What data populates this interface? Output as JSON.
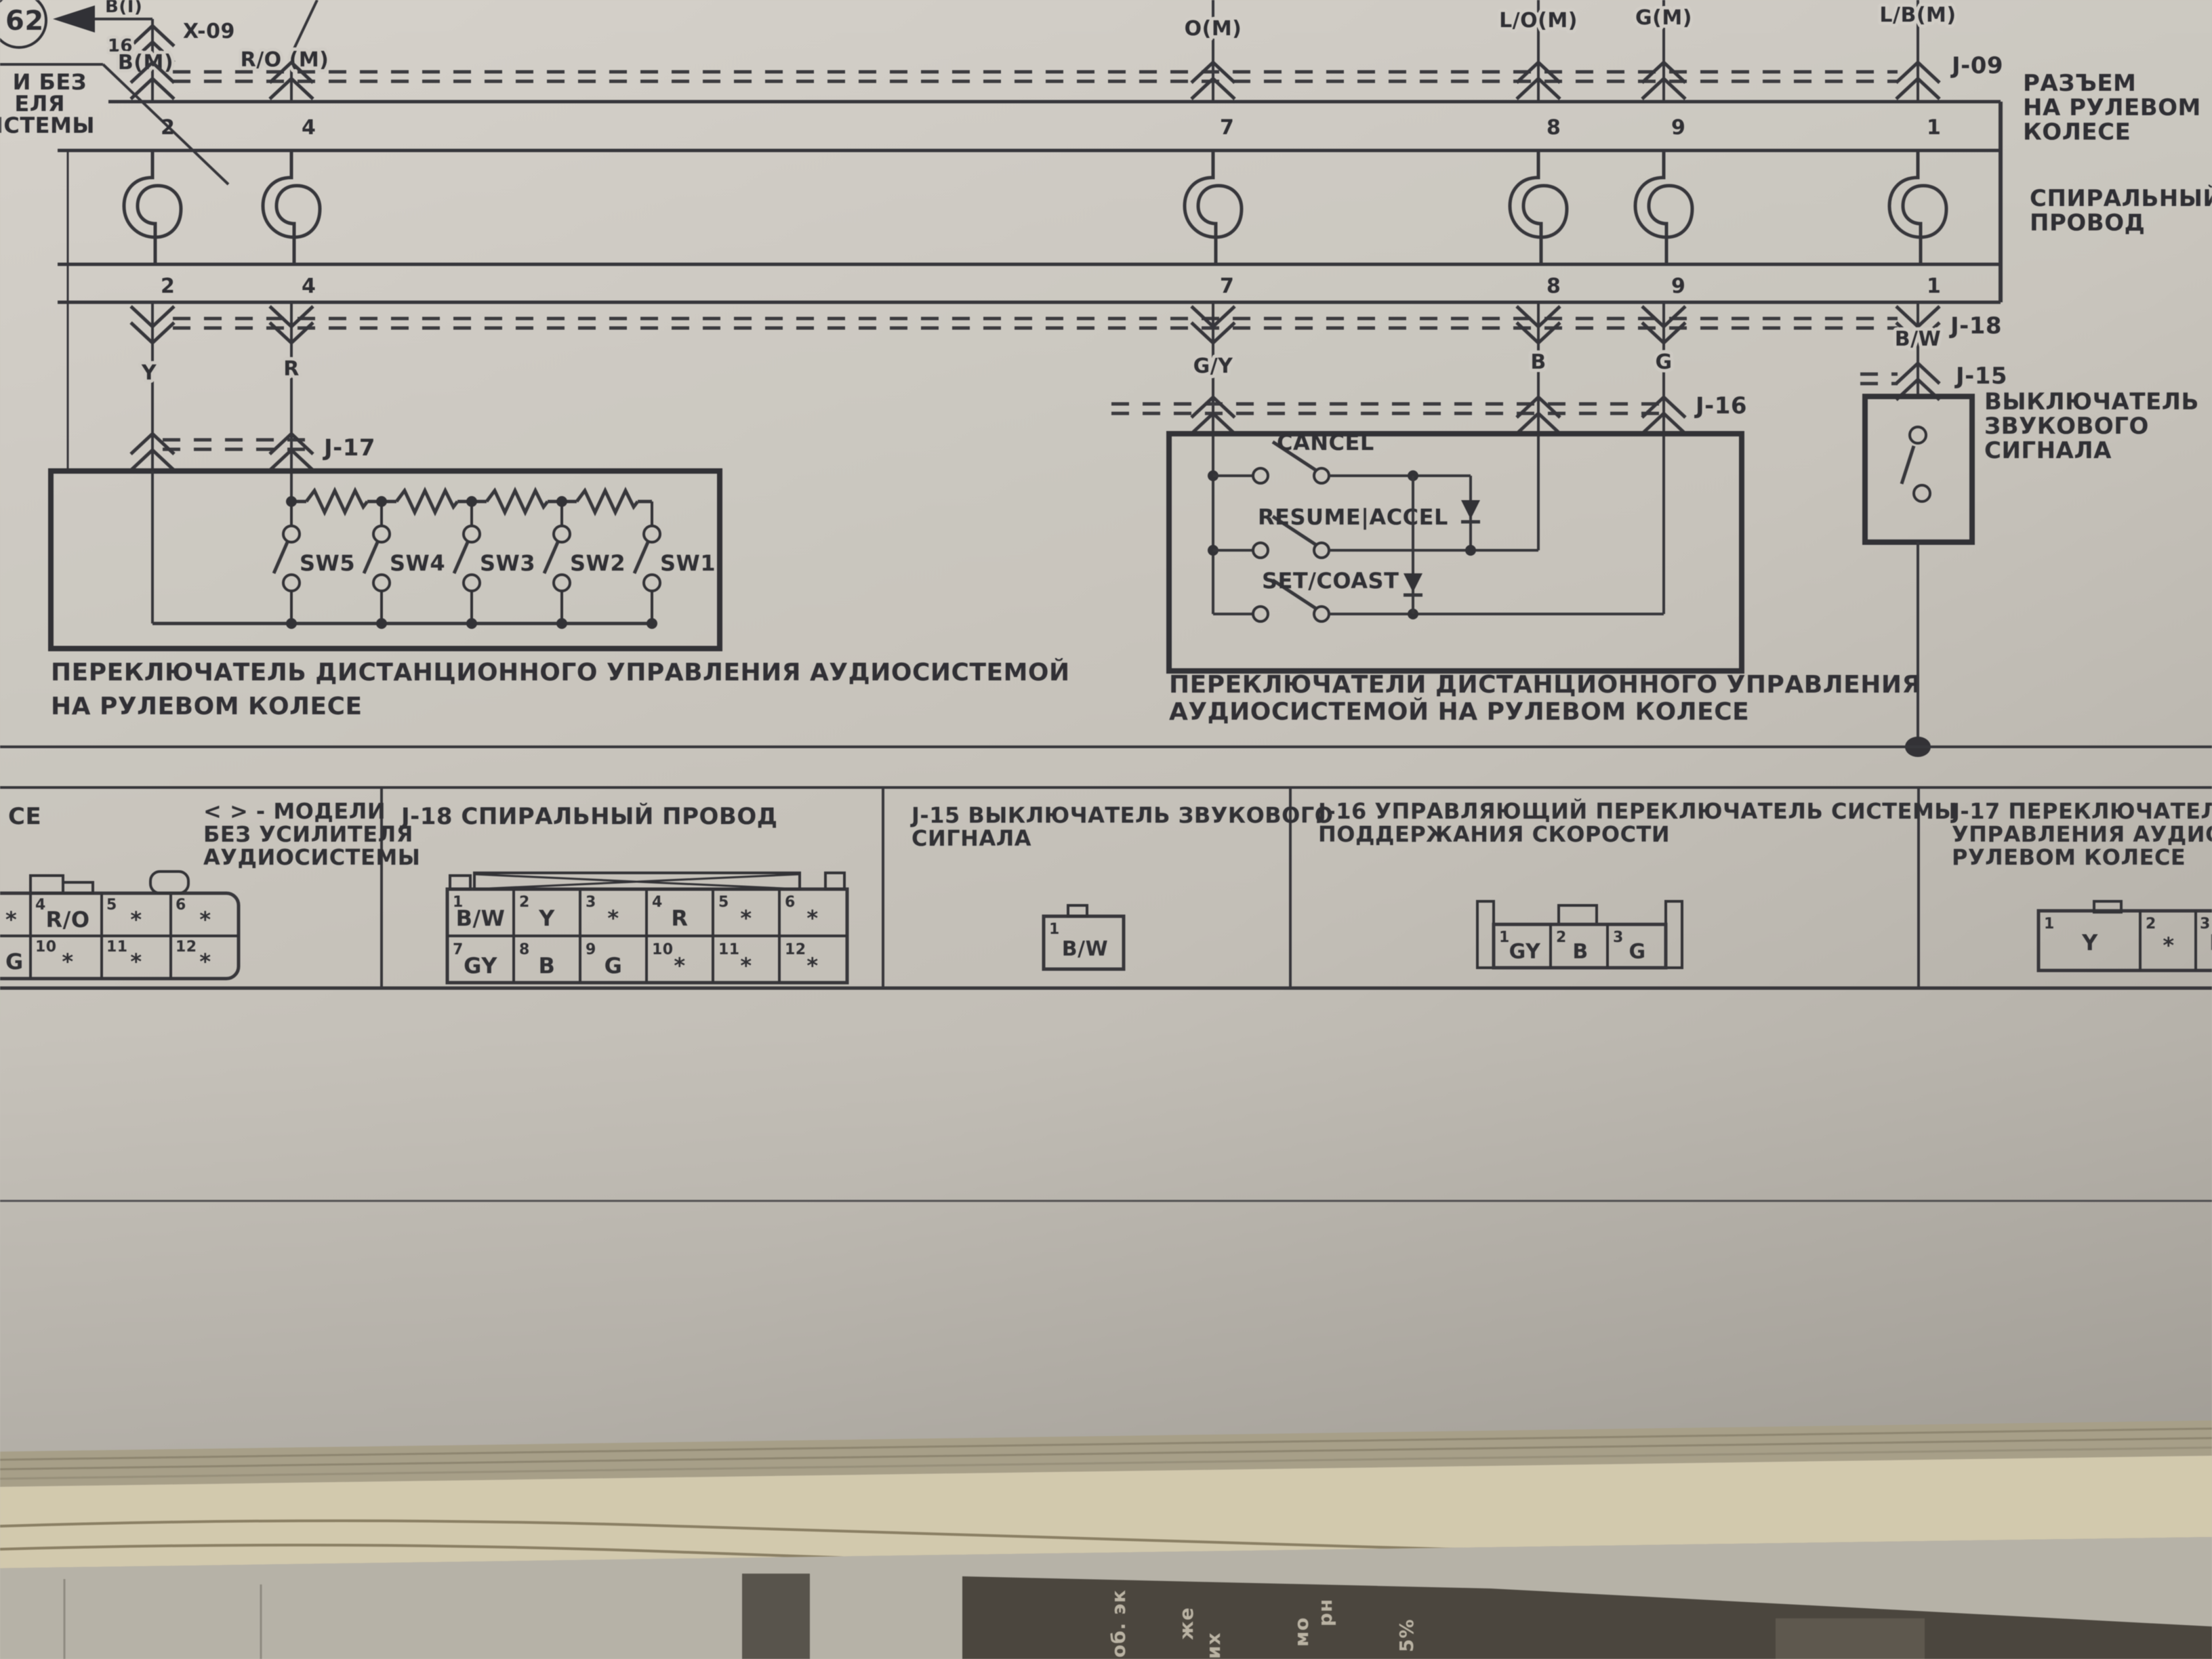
{
  "ink_color": "#2d2d32",
  "paper_color": "#d3cfc7",
  "header": {
    "page_ref": "62",
    "wire_bi_label": "B(I)",
    "x09_label": "X-09",
    "x09_pin": "16",
    "left_note_fragments": [
      "И БЕЗ",
      "ЕЛЯ",
      "ИСТЕМЫ"
    ]
  },
  "bus": {
    "j09_label": "J-09",
    "j09_name_lines": [
      "РАЗЪЕМ",
      "НА РУЛЕВОМ",
      "КОЛЕСЕ"
    ],
    "spiral_name_lines": [
      "СПИРАЛЬНЫЙ",
      "ПРОВОД"
    ],
    "j18_label": "J-18",
    "wires": [
      {
        "top_label": "B(M)",
        "pin": "2",
        "color_label": "Y"
      },
      {
        "top_label": "R/O (M)",
        "pin": "4",
        "color_label": "R"
      },
      {
        "top_label": "O(M)",
        "pin": "7",
        "color_label": "G/Y"
      },
      {
        "top_label": "L/O(M)",
        "pin": "8",
        "color_label": "B"
      },
      {
        "top_label": "G(M)",
        "pin": "9",
        "color_label": "G"
      },
      {
        "top_label": "L/B(M)",
        "pin": "1",
        "color_label": "B/W"
      }
    ]
  },
  "audio_switch_box": {
    "j17_label": "J-17",
    "switches": [
      "SW5",
      "SW4",
      "SW3",
      "SW2",
      "SW1"
    ],
    "caption_lines": [
      "ПЕРЕКЛЮЧАТЕЛЬ ДИСТАНЦИОННОГО УПРАВЛЕНИЯ АУДИОСИСТЕМОЙ",
      "НА РУЛЕВОМ КОЛЕСЕ"
    ]
  },
  "cruise_switch_box": {
    "j16_label": "J-16",
    "buttons": [
      "CANCEL",
      "RESUME|ACCEL",
      "SET/COAST"
    ],
    "caption_lines": [
      "ПЕРЕКЛЮЧАТЕЛИ ДИСТАНЦИОННОГО УПРАВЛЕНИЯ",
      "АУДИОСИСТЕМОЙ НА РУЛЕВОМ КОЛЕСЕ"
    ]
  },
  "horn_switch": {
    "j15_label": "J-15",
    "name_lines": [
      "ВЫКЛЮЧАТЕЛЬ",
      "ЗВУКОВОГО",
      "СИГНАЛА"
    ]
  },
  "connector_table": {
    "left_cell": {
      "fragment": "СЕ",
      "note_lines": [
        "< > - МОДЕЛИ",
        "БЕЗ УСИЛИТЕЛЯ",
        "АУДИОСИСТЕМЫ"
      ],
      "row1": [
        [
          "",
          "*"
        ],
        [
          "4",
          "R/O"
        ],
        [
          "5",
          "*"
        ],
        [
          "6",
          "*"
        ]
      ],
      "row2": [
        [
          "",
          "G"
        ],
        [
          "10",
          "*"
        ],
        [
          "11",
          "*"
        ],
        [
          "12",
          "*"
        ]
      ]
    },
    "j18": {
      "title": "J-18 СПИРАЛЬНЫЙ ПРОВОД",
      "row1": [
        [
          "1",
          "B/W"
        ],
        [
          "2",
          "Y"
        ],
        [
          "3",
          "*"
        ],
        [
          "4",
          "R"
        ],
        [
          "5",
          "*"
        ],
        [
          "6",
          "*"
        ]
      ],
      "row2": [
        [
          "7",
          "GY"
        ],
        [
          "8",
          "B"
        ],
        [
          "9",
          "G"
        ],
        [
          "10",
          "*"
        ],
        [
          "11",
          "*"
        ],
        [
          "12",
          "*"
        ]
      ]
    },
    "j15": {
      "title_lines": [
        "J-15 ВЫКЛЮЧАТЕЛЬ ЗВУКОВОГО",
        "СИГНАЛА"
      ],
      "pin": [
        "1",
        "B/W"
      ]
    },
    "j16": {
      "title_lines": [
        "J-16 УПРАВЛЯЮЩИЙ ПЕРЕКЛЮЧАТЕЛЬ СИСТЕМЫ",
        "ПОДДЕРЖАНИЯ СКОРОСТИ"
      ],
      "pins": [
        [
          "1",
          "GY"
        ],
        [
          "2",
          "B"
        ],
        [
          "3",
          "G"
        ]
      ]
    },
    "j17": {
      "title_lines": [
        "J-17 ПЕРЕКЛЮЧАТЕЛЬ ДИСТА",
        "УПРАВЛЕНИЯ АУДИОСИСТЕМ",
        "РУЛЕВОМ КОЛЕСЕ"
      ],
      "pins": [
        [
          "1",
          "Y"
        ],
        [
          "2",
          "*"
        ],
        [
          "3",
          "R"
        ]
      ]
    }
  },
  "photo_bottom": {
    "newspaper_fragments": [
      "об. эк",
      "же",
      "их",
      "мо",
      "рн",
      "5%"
    ]
  }
}
